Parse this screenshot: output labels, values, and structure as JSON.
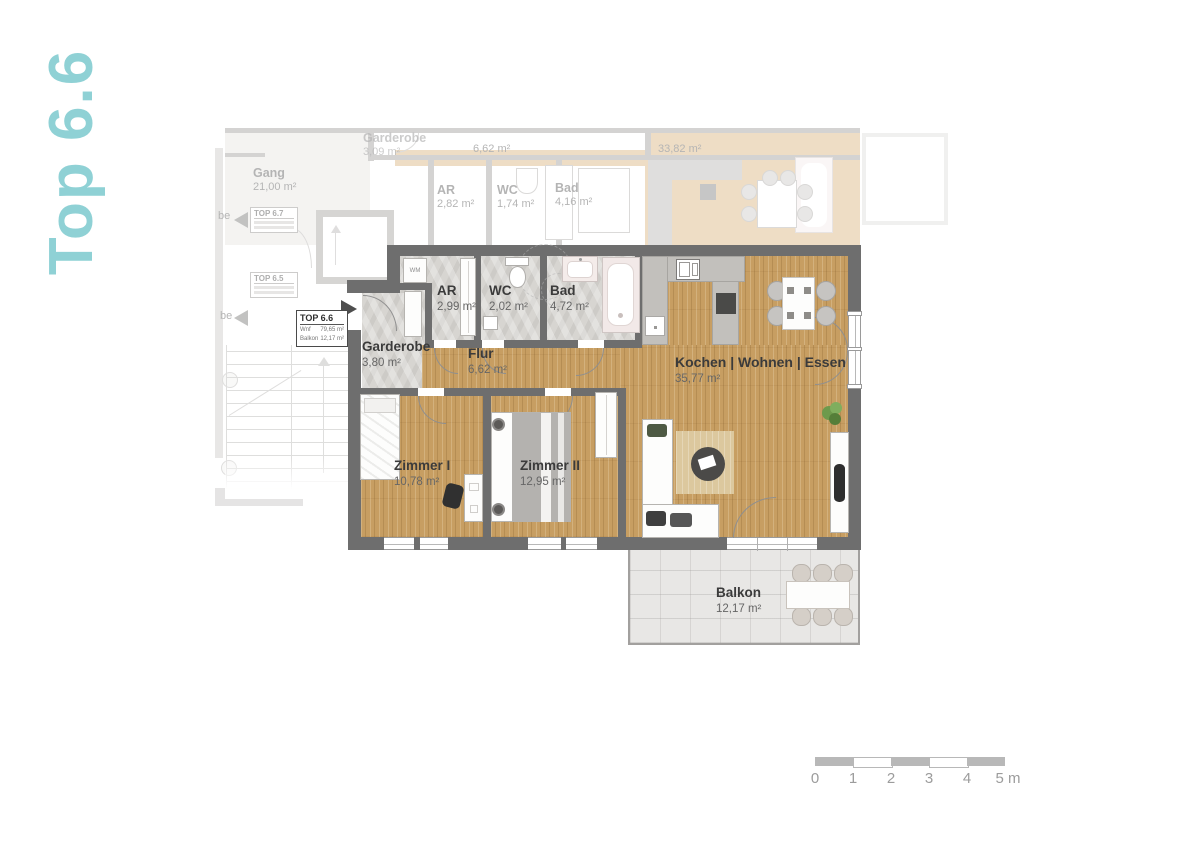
{
  "page": {
    "title_vertical": "Top 6.6"
  },
  "colors": {
    "accent": "#8fd1d5",
    "wall": "#6e6e6e",
    "wood": "#c79e62",
    "stone": "#d7d5d1",
    "balcony": "#e8e7e5",
    "counter": "#c2c0bc",
    "label": "#3b3b3b",
    "area_text": "#666666"
  },
  "unit_label": {
    "title": "TOP 6.6",
    "rows": [
      {
        "label": "Wnf",
        "value": "79,65 m²"
      },
      {
        "label": "Balkon",
        "value": "12,17 m²"
      }
    ]
  },
  "rooms": [
    {
      "name": "Garderobe",
      "area": "3,80 m²"
    },
    {
      "name": "AR",
      "area": "2,99 m²"
    },
    {
      "name": "WC",
      "area": "2,02 m²"
    },
    {
      "name": "Bad",
      "area": "4,72 m²"
    },
    {
      "name": "Flur",
      "area": "6,62 m²"
    },
    {
      "name": "Kochen | Wohnen | Essen",
      "area": "35,77 m²"
    },
    {
      "name": "Zimmer I",
      "area": "10,78 m²"
    },
    {
      "name": "Zimmer II",
      "area": "12,95 m²"
    },
    {
      "name": "Balkon",
      "area": "12,17 m²"
    }
  ],
  "fixtures": {
    "washing_machine": "WM"
  },
  "background_plan": {
    "rooms": [
      {
        "name": "Gang",
        "area": "21,00 m²"
      },
      {
        "name": "Garderobe",
        "area": "3,09 m²"
      },
      {
        "name": "",
        "area": "6,62 m²"
      },
      {
        "name": "",
        "area": "33,82 m²"
      },
      {
        "name": "AR",
        "area": "2,82 m²"
      },
      {
        "name": "WC",
        "area": "1,74 m²"
      },
      {
        "name": "Bad",
        "area": "4,16 m²"
      }
    ],
    "tags": [
      {
        "label": "be"
      },
      {
        "label": "TOP 6.7"
      },
      {
        "label": "TOP 6.5"
      },
      {
        "label": "be"
      }
    ]
  },
  "scale_bar": {
    "ticks": [
      "0",
      "1",
      "2",
      "3",
      "4",
      "5 m"
    ]
  }
}
